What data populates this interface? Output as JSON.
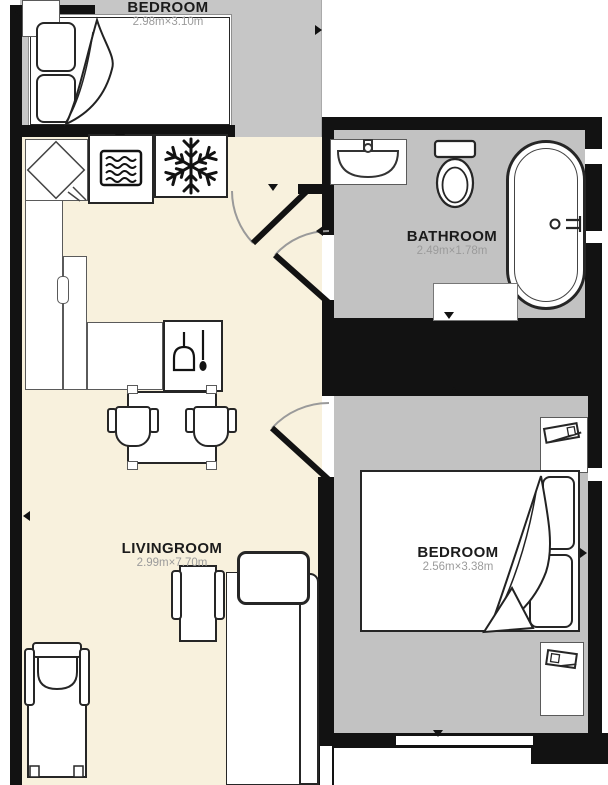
{
  "title": "Apartment floor plan",
  "colors": {
    "wall": "#121212",
    "gray_floor": "#c6c6c6",
    "cream_floor": "#f8f1dd",
    "furniture_line": "#262626",
    "room_name_text": "#1b1b1b",
    "dimension_text": "#9b9b9b"
  },
  "rooms": {
    "bedroom_top": {
      "name": "BEDROOM",
      "dims": "2.98m×3.10m"
    },
    "bathroom": {
      "name": "BATHROOM",
      "dims": "2.49m×1.78m"
    },
    "livingroom": {
      "name": "LIVINGROOM",
      "dims": "2.99m×7.70m"
    },
    "bedroom_right": {
      "name": "BEDROOM",
      "dims": "2.56m×3.38m"
    }
  },
  "fixtures": [
    "double-bed",
    "wardrobe",
    "corner-kitchen-unit",
    "oven-waves-appliance",
    "freezer-snowflake",
    "kitchen-counter",
    "dishwasher-wine-glass",
    "dining-table",
    "dining-chair",
    "dining-chair",
    "chaise-lounge",
    "armchair",
    "sofa",
    "wash-basin",
    "toilet",
    "bathtub",
    "bath-mat",
    "desk-laptop",
    "double-bed",
    "nightstand-lamp"
  ]
}
